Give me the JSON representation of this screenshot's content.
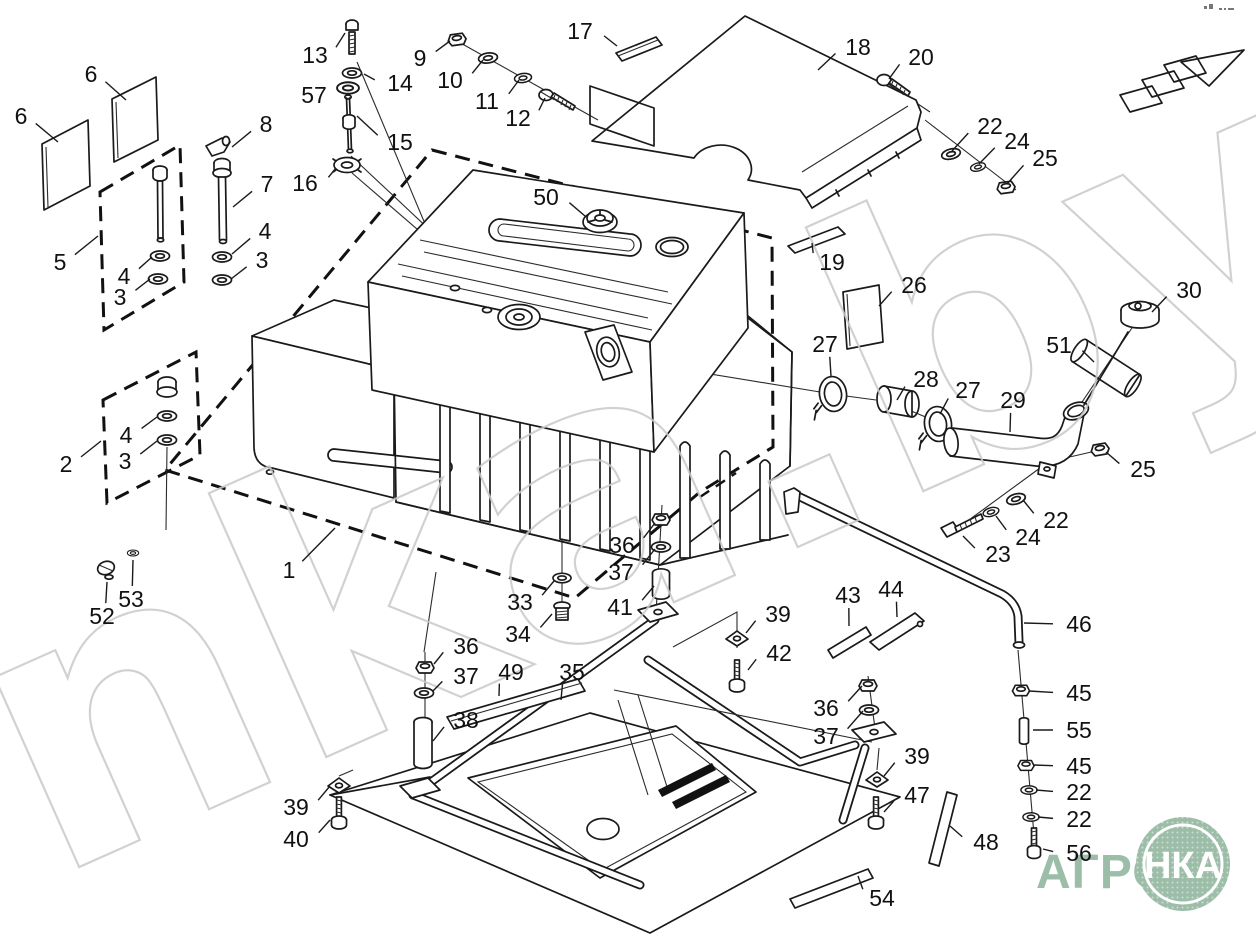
{
  "page": {
    "watermark": "nka.by",
    "logo": {
      "word": "АГРО",
      "badge": "НКА",
      "green": "#9cbda7"
    },
    "ink": "#1a1a1a",
    "callouts": [
      {
        "n": "6",
        "x": 21,
        "y": 116,
        "tx": 58,
        "ty": 142
      },
      {
        "n": "6",
        "x": 91,
        "y": 74,
        "tx": 126,
        "ty": 100
      },
      {
        "n": "5",
        "x": 60,
        "y": 262,
        "tx": 98,
        "ty": 236
      },
      {
        "n": "13",
        "x": 315,
        "y": 55,
        "tx": 345,
        "ty": 33
      },
      {
        "n": "14",
        "x": 400,
        "y": 83,
        "tx": 364,
        "ty": 74
      },
      {
        "n": "57",
        "x": 314,
        "y": 95,
        "tx": 337,
        "ty": 89
      },
      {
        "n": "8",
        "x": 266,
        "y": 124,
        "tx": 232,
        "ty": 147
      },
      {
        "n": "7",
        "x": 267,
        "y": 184,
        "tx": 233,
        "ty": 207
      },
      {
        "n": "15",
        "x": 400,
        "y": 142,
        "tx": 357,
        "ty": 116
      },
      {
        "n": "16",
        "x": 305,
        "y": 183,
        "tx": 336,
        "ty": 168
      },
      {
        "n": "4",
        "x": 265,
        "y": 231,
        "tx": 232,
        "ty": 254
      },
      {
        "n": "3",
        "x": 262,
        "y": 260,
        "tx": 231,
        "ty": 279
      },
      {
        "n": "4",
        "x": 124,
        "y": 276,
        "tx": 152,
        "ty": 257
      },
      {
        "n": "3",
        "x": 120,
        "y": 297,
        "tx": 150,
        "ty": 279
      },
      {
        "n": "9",
        "x": 420,
        "y": 58,
        "tx": 450,
        "ty": 41
      },
      {
        "n": "10",
        "x": 450,
        "y": 80,
        "tx": 483,
        "ty": 60
      },
      {
        "n": "11",
        "x": 487,
        "y": 101,
        "tx": 519,
        "ty": 80
      },
      {
        "n": "12",
        "x": 518,
        "y": 118,
        "tx": 545,
        "ty": 98
      },
      {
        "n": "17",
        "x": 580,
        "y": 31,
        "tx": 617,
        "ty": 46
      },
      {
        "n": "18",
        "x": 858,
        "y": 47,
        "tx": 818,
        "ty": 70
      },
      {
        "n": "20",
        "x": 921,
        "y": 57,
        "tx": 889,
        "ty": 79
      },
      {
        "n": "22",
        "x": 990,
        "y": 126,
        "tx": 952,
        "ty": 151
      },
      {
        "n": "24",
        "x": 1017,
        "y": 141,
        "tx": 979,
        "ty": 164
      },
      {
        "n": "25",
        "x": 1045,
        "y": 158,
        "tx": 1007,
        "ty": 184
      },
      {
        "n": "19",
        "x": 832,
        "y": 262,
        "tx": 812,
        "ty": 243
      },
      {
        "n": "50",
        "x": 546,
        "y": 197,
        "tx": 585,
        "ty": 216
      },
      {
        "n": "26",
        "x": 914,
        "y": 285,
        "tx": 879,
        "ty": 306
      },
      {
        "n": "30",
        "x": 1189,
        "y": 290,
        "tx": 1152,
        "ty": 312
      },
      {
        "n": "51",
        "x": 1059,
        "y": 345,
        "tx": 1094,
        "ty": 362
      },
      {
        "n": "27",
        "x": 825,
        "y": 344,
        "tx": 831,
        "ty": 376
      },
      {
        "n": "28",
        "x": 926,
        "y": 379,
        "tx": 897,
        "ty": 400
      },
      {
        "n": "27",
        "x": 968,
        "y": 390,
        "tx": 940,
        "ty": 414
      },
      {
        "n": "29",
        "x": 1013,
        "y": 400,
        "tx": 1010,
        "ty": 432
      },
      {
        "n": "25",
        "x": 1143,
        "y": 469,
        "tx": 1106,
        "ty": 452
      },
      {
        "n": "22",
        "x": 1056,
        "y": 520,
        "tx": 1023,
        "ty": 500
      },
      {
        "n": "24",
        "x": 1028,
        "y": 537,
        "tx": 996,
        "ty": 516
      },
      {
        "n": "23",
        "x": 998,
        "y": 554,
        "tx": 963,
        "ty": 536
      },
      {
        "n": "2",
        "x": 66,
        "y": 464,
        "tx": 101,
        "ty": 441
      },
      {
        "n": "4",
        "x": 126,
        "y": 435,
        "tx": 157,
        "ty": 417
      },
      {
        "n": "3",
        "x": 125,
        "y": 461,
        "tx": 157,
        "ty": 441
      },
      {
        "n": "1",
        "x": 289,
        "y": 570,
        "tx": 335,
        "ty": 528
      },
      {
        "n": "52",
        "x": 102,
        "y": 616,
        "tx": 107,
        "ty": 582
      },
      {
        "n": "53",
        "x": 131,
        "y": 599,
        "tx": 133,
        "ty": 560
      },
      {
        "n": "36",
        "x": 622,
        "y": 545,
        "tx": 655,
        "ty": 523
      },
      {
        "n": "37",
        "x": 621,
        "y": 572,
        "tx": 655,
        "ty": 549
      },
      {
        "n": "41",
        "x": 620,
        "y": 607,
        "tx": 654,
        "ty": 586
      },
      {
        "n": "33",
        "x": 520,
        "y": 602,
        "tx": 554,
        "ty": 581
      },
      {
        "n": "34",
        "x": 518,
        "y": 634,
        "tx": 552,
        "ty": 614
      },
      {
        "n": "36",
        "x": 466,
        "y": 646,
        "tx": 434,
        "ty": 664
      },
      {
        "n": "37",
        "x": 466,
        "y": 676,
        "tx": 433,
        "ty": 691
      },
      {
        "n": "38",
        "x": 466,
        "y": 720,
        "tx": 433,
        "ty": 741
      },
      {
        "n": "49",
        "x": 511,
        "y": 672,
        "tx": 499,
        "ty": 696
      },
      {
        "n": "35",
        "x": 572,
        "y": 672,
        "tx": 561,
        "ty": 700
      },
      {
        "n": "39",
        "x": 778,
        "y": 614,
        "tx": 746,
        "ty": 633
      },
      {
        "n": "42",
        "x": 779,
        "y": 653,
        "tx": 748,
        "ty": 670
      },
      {
        "n": "43",
        "x": 848,
        "y": 595,
        "tx": 849,
        "ty": 626
      },
      {
        "n": "44",
        "x": 891,
        "y": 589,
        "tx": 897,
        "ty": 617
      },
      {
        "n": "46",
        "x": 1079,
        "y": 624,
        "tx": 1024,
        "ty": 623
      },
      {
        "n": "45",
        "x": 1079,
        "y": 693,
        "tx": 1029,
        "ty": 691
      },
      {
        "n": "55",
        "x": 1079,
        "y": 730,
        "tx": 1033,
        "ty": 730
      },
      {
        "n": "45",
        "x": 1079,
        "y": 766,
        "tx": 1034,
        "ty": 765
      },
      {
        "n": "22",
        "x": 1079,
        "y": 792,
        "tx": 1036,
        "ty": 790
      },
      {
        "n": "22",
        "x": 1079,
        "y": 819,
        "tx": 1038,
        "ty": 817
      },
      {
        "n": "56",
        "x": 1079,
        "y": 853,
        "tx": 1043,
        "ty": 849
      },
      {
        "n": "36",
        "x": 826,
        "y": 708,
        "tx": 862,
        "ty": 686
      },
      {
        "n": "37",
        "x": 826,
        "y": 736,
        "tx": 863,
        "ty": 711
      },
      {
        "n": "39",
        "x": 917,
        "y": 756,
        "tx": 884,
        "ty": 776
      },
      {
        "n": "47",
        "x": 917,
        "y": 795,
        "tx": 884,
        "ty": 812
      },
      {
        "n": "48",
        "x": 986,
        "y": 842,
        "tx": 950,
        "ty": 826
      },
      {
        "n": "54",
        "x": 882,
        "y": 898,
        "tx": 858,
        "ty": 876
      },
      {
        "n": "39",
        "x": 296,
        "y": 807,
        "tx": 330,
        "ty": 786
      },
      {
        "n": "40",
        "x": 296,
        "y": 839,
        "tx": 330,
        "ty": 820
      }
    ]
  }
}
